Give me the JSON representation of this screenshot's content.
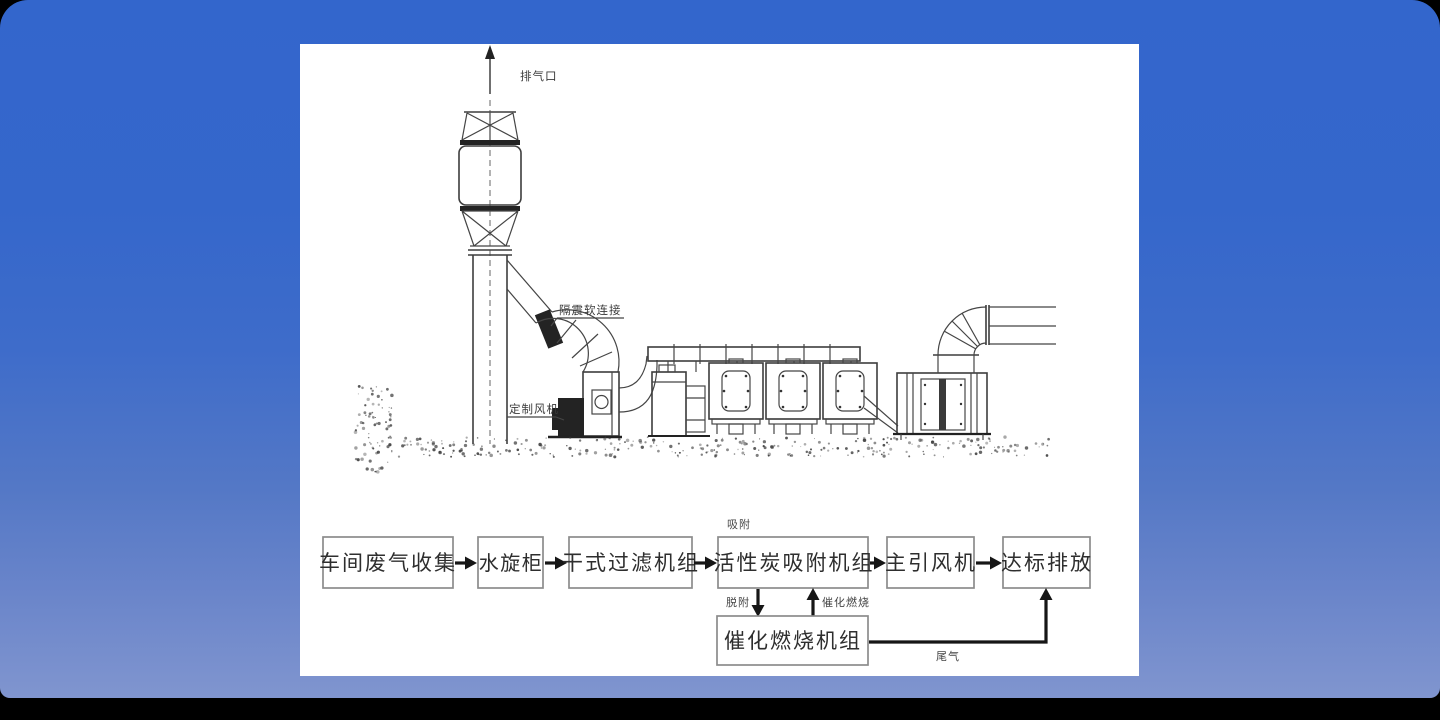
{
  "window": {
    "background_top_color": "#3366cc",
    "background_bottom_color": "#8095cf",
    "slide_background_color": "#ffffff"
  },
  "illustration": {
    "labels": {
      "exhaust_outlet": "排气口",
      "vibration_soft_connection": "隔震软连接",
      "custom_fan": "定制风机"
    }
  },
  "flowchart": {
    "main_boxes": [
      "车间废气收集",
      "水旋柜",
      "干式过滤机组",
      "活性炭吸附机组",
      "主引风机",
      "达标排放"
    ],
    "branch_box": "催化燃烧机组",
    "annotations": {
      "adsorption": "吸附",
      "desorption": "脱附",
      "catalytic_combustion": "催化燃烧",
      "tail_gas": "尾气"
    }
  }
}
